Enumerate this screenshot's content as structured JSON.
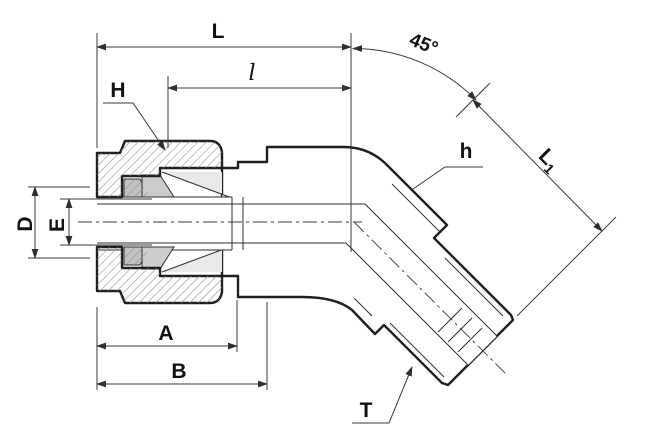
{
  "drawing": {
    "dimension_labels": {
      "overall_length": "L",
      "insertion_length": "l",
      "angle": "45°",
      "nut_hex": "H",
      "body_hex": "h",
      "leg_length_base": "L",
      "leg_length_subscript": "1",
      "diameter_outer": "D",
      "diameter_inner": "E",
      "length_a": "A",
      "length_b": "B",
      "thread": "T"
    },
    "colors": {
      "background": "#ffffff",
      "outline": "#1f1f1f",
      "dimension_lines": "#3a3a3a",
      "body_fill": "#e9e9e9",
      "nut_fill": "#d3d3d3",
      "ferrule_fill": "#c2c2c2",
      "hatch": "#8a8a8a"
    }
  }
}
